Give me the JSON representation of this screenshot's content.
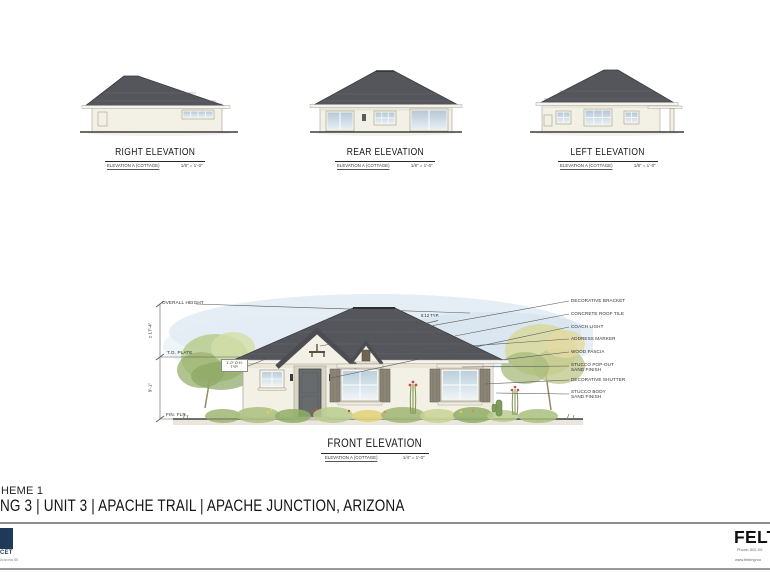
{
  "elevations": {
    "right": {
      "title": "RIGHT ELEVATION",
      "subtitle": "ELEVATION A (COTTAGE)",
      "scale": "1/8\" = 1'-0\""
    },
    "rear": {
      "title": "REAR ELEVATION",
      "subtitle": "ELEVATION A (COTTAGE)",
      "scale": "1/8\" = 1'-0\""
    },
    "left": {
      "title": "LEFT ELEVATION",
      "subtitle": "ELEVATION A (COTTAGE)",
      "scale": "1/8\" = 1'-0\""
    },
    "front": {
      "title": "FRONT ELEVATION",
      "subtitle": "ELEVATION A (COTTAGE)",
      "scale": "1/4\" = 1'-0\""
    }
  },
  "annotations": {
    "overall_height": "OVERALL HEIGHT",
    "dim_overall": "± 17'-4\"",
    "top_plate": "T.O. PLATE",
    "dim_plate": "9'-1\"",
    "fin_floor": "FIN. FLR.",
    "overhang": "1'-0\" O.H. TYP.",
    "pitch": "5:12 TYP.",
    "callouts": [
      {
        "line1": "DECORATIVE BRACKET",
        "line2": ""
      },
      {
        "line1": "CONCRETE ROOF TILE",
        "line2": ""
      },
      {
        "line1": "COACH LIGHT",
        "line2": ""
      },
      {
        "line1": "ADDRESS MARKER",
        "line2": ""
      },
      {
        "line1": "WOOD FASCIA",
        "line2": ""
      },
      {
        "line1": "STUCCO POP-OUT",
        "line2": "SAND FINISH"
      },
      {
        "line1": "DECORATIVE SHUTTER",
        "line2": ""
      },
      {
        "line1": "STUCCO BODY",
        "line2": "SAND FINISH"
      }
    ]
  },
  "sheet_title": {
    "scheme": "HEME 1",
    "project": "NG 3 | UNIT 3 | APACHE TRAIL | APACHE JUNCTION, ARIZONA"
  },
  "footer": {
    "logo_left_text": "CET",
    "logo_left_sub": "Arizona 85",
    "brand": "FELT",
    "phone": "Phone: 602.XX",
    "web": "www.feltengrou"
  },
  "colors": {
    "roof": "#55565c",
    "wall": "#f3f0e5",
    "shutter": "#8b8578",
    "glass": "#c2d3e0",
    "sky": "#d7e5f0",
    "navy": "#1e3a56",
    "ground_line": "#3b3b3b"
  }
}
